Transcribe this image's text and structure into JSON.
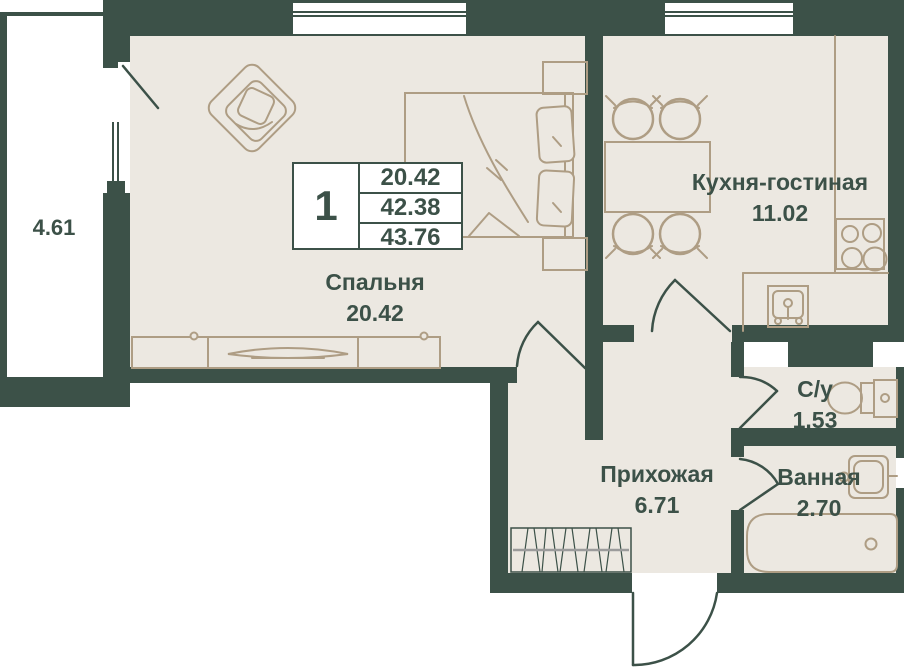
{
  "colors": {
    "wall": "#3C5148",
    "floor": "#ECE8E1",
    "furniture_line": "#AE9D84",
    "label_text": "#3C5148",
    "background": "#FFFFFF"
  },
  "info_table": {
    "rooms_count": "1",
    "areas": [
      "20.42",
      "42.38",
      "43.76"
    ]
  },
  "rooms": {
    "balcony": {
      "area": "4.61"
    },
    "bedroom": {
      "name": "Спальня",
      "area": "20.42"
    },
    "kitchen_living": {
      "name": "Кухня-гостиная",
      "area": "11.02"
    },
    "hallway": {
      "name": "Прихожая",
      "area": "6.71"
    },
    "wc": {
      "name": "С/у",
      "area": "1.53"
    },
    "bathroom": {
      "name": "Ванная",
      "area": "2.70"
    }
  }
}
